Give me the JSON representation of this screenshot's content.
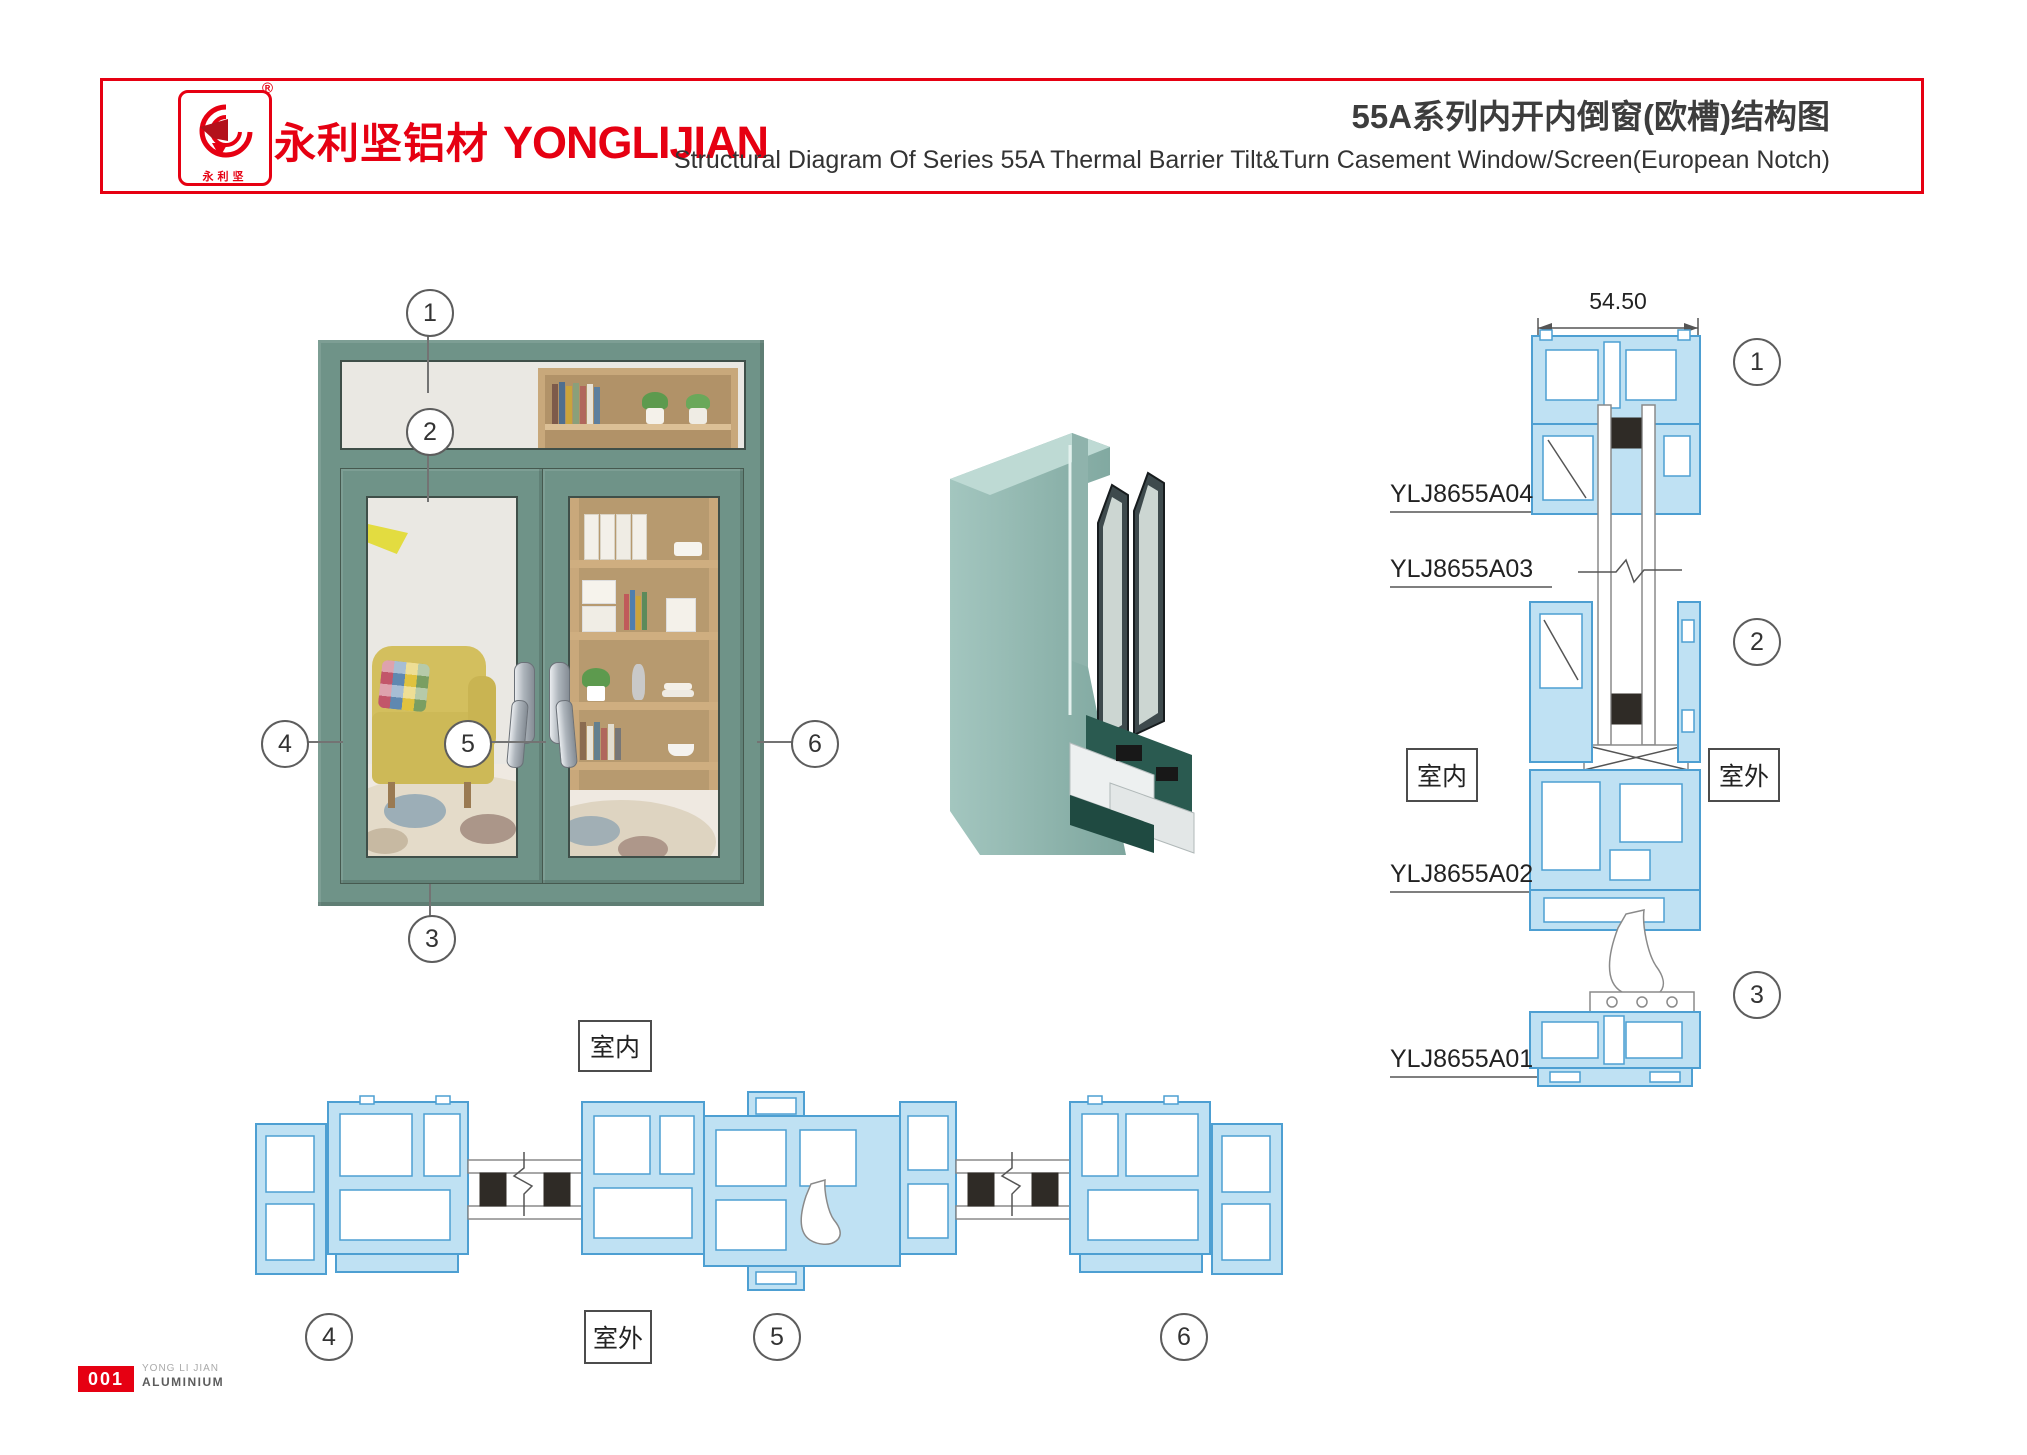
{
  "header": {
    "brand_cn": "永利坚铝材",
    "brand_en": "YONGLIJIAN",
    "registered": "®",
    "logo_text": "永利坚",
    "title_cn": "55A系列内开内倒窗(欧槽)结构图",
    "title_en": "Structural Diagram Of Series 55A Thermal Barrier Tilt&Turn Casement Window/Screen(European Notch)"
  },
  "front_view": {
    "callouts": [
      "1",
      "2",
      "3",
      "4",
      "5",
      "6"
    ]
  },
  "vertical_section": {
    "dimension": "54.50",
    "labels": {
      "a04": "YLJ8655A04",
      "a03": "YLJ8655A03",
      "a02": "YLJ8655A02",
      "a01": "YLJ8655A01"
    },
    "indoor": "室内",
    "outdoor": "室外",
    "callouts": [
      "1",
      "2",
      "3"
    ]
  },
  "plan_section": {
    "indoor": "室内",
    "outdoor": "室外",
    "callouts": [
      "4",
      "5",
      "6"
    ]
  },
  "footer": {
    "page_no": "001",
    "brand_small_1": "YONG LI JIAN",
    "brand_small_2": "ALUMINIUM"
  },
  "colors": {
    "accent_red": "#e60012",
    "profile_stroke": "#4d9fd2",
    "profile_fill": "#bfe1f3",
    "window_green": "#6f9388",
    "render_teal": "#8fb5ae"
  }
}
